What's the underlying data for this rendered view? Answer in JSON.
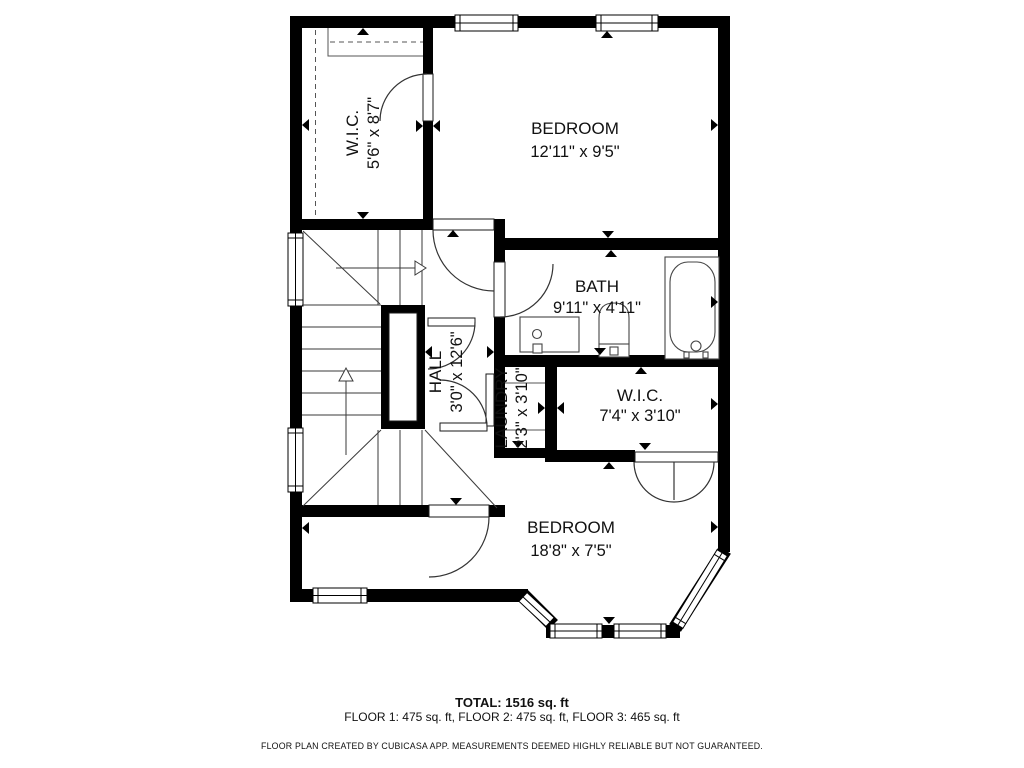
{
  "plan": {
    "rooms": [
      {
        "name": "W.I.C.",
        "dims": "5'6\" x 8'7\""
      },
      {
        "name": "BEDROOM",
        "dims": "12'11\" x 9'5\""
      },
      {
        "name": "BATH",
        "dims": "9'11\" x 4'11\""
      },
      {
        "name": "HALL",
        "dims": "3'0\" x 12'6\""
      },
      {
        "name": "LAUNDRY",
        "dims": "2'3\" x 3'10\""
      },
      {
        "name": "W.I.C.",
        "dims": "7'4\" x 3'10\""
      },
      {
        "name": "BEDROOM",
        "dims": "18'8\" x 7'5\""
      }
    ],
    "summary": {
      "total": "TOTAL: 1516 sq. ft",
      "floors": "FLOOR 1: 475 sq. ft, FLOOR 2: 475 sq. ft, FLOOR 3: 465 sq. ft",
      "disclaimer": "FLOOR PLAN CREATED BY CUBICASA APP. MEASUREMENTS DEEMED HIGHLY RELIABLE BUT NOT GUARANTEED."
    },
    "colors": {
      "wall": "#000000",
      "background": "#ffffff",
      "thin_line": "#3a3a3a"
    }
  }
}
